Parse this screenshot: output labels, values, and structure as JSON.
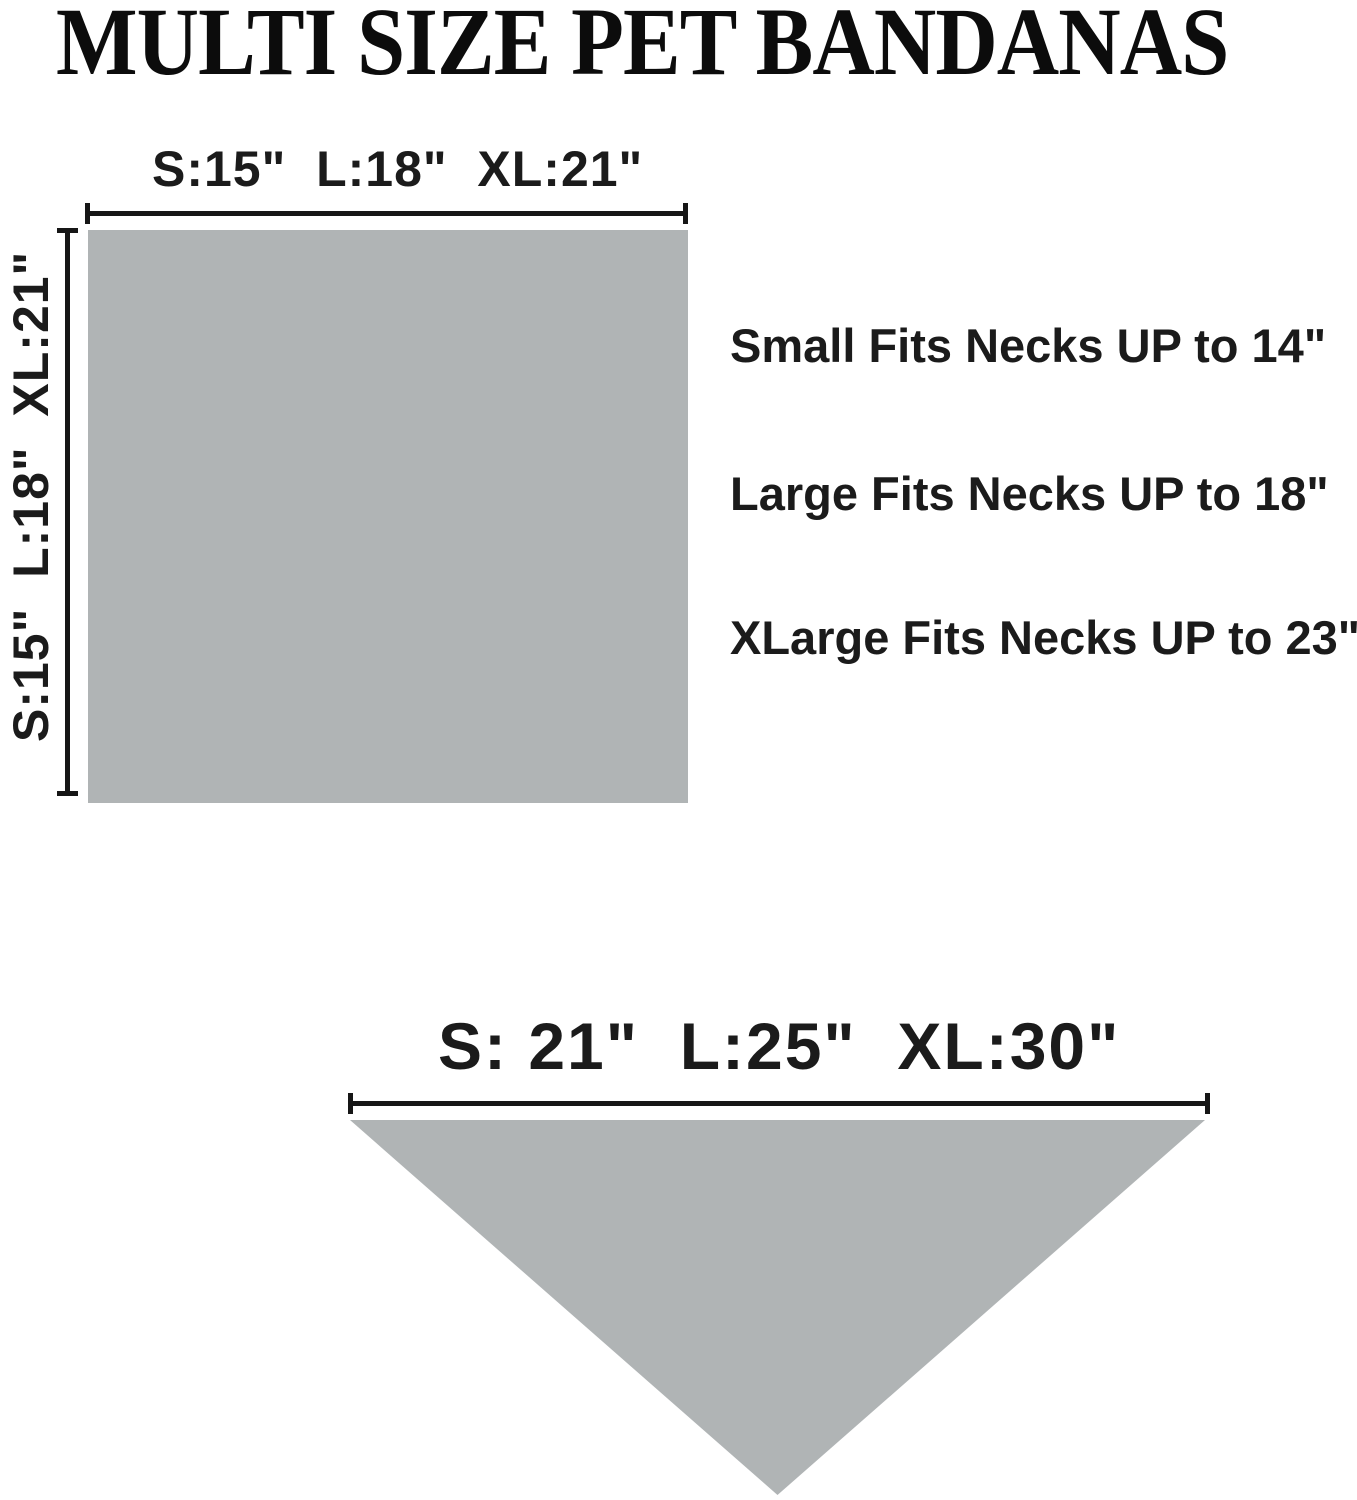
{
  "title": "MULTI SIZE PET BANDANAS",
  "square_diagram": {
    "shape": "square",
    "top_dimension_label": "S:15\"  L:18\"  XL:21\"",
    "side_dimension_label": "S:15\"  L:18\"  XL:21\""
  },
  "fit_notes": {
    "small": "Small Fits Necks UP to 14\"",
    "large": "Large Fits Necks UP to 18\"",
    "xlarge": "XLarge Fits Necks UP to 23\""
  },
  "triangle_diagram": {
    "shape": "triangle",
    "top_dimension_label": "S: 21\"  L:25\"  XL:30\""
  },
  "colors": {
    "background": "#ffffff",
    "shape_fill": "#b0b4b5",
    "text": "#1b1b1b",
    "line": "#161616"
  }
}
